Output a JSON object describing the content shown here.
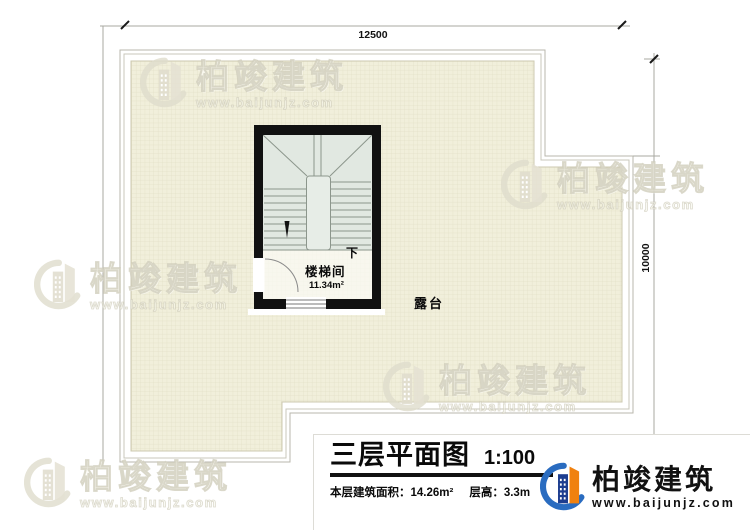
{
  "plan": {
    "dimensions": {
      "width": "12500",
      "height": "10000"
    },
    "labels": {
      "stair_room": "楼梯间",
      "stair_area": "11.34m²",
      "down": "下",
      "terrace": "露台"
    }
  },
  "title_block": {
    "title": "三层平面图",
    "scale": "1:100",
    "area_info": "本层建筑面积：14.26m²",
    "height_info": "层高：3.3m"
  },
  "brand": {
    "name": "柏竣建筑",
    "url": "www.baijunjz.com"
  },
  "watermark": {
    "name": "柏竣建筑",
    "url": "www.baijunjz.com"
  },
  "colors": {
    "wall": "#111111",
    "tile": "#f1efdb",
    "stair_floor": "#e1e8e1",
    "brand_blue": "#2a6cc0",
    "brand_navy": "#1d3d8f",
    "brand_orange": "#f0810f"
  }
}
